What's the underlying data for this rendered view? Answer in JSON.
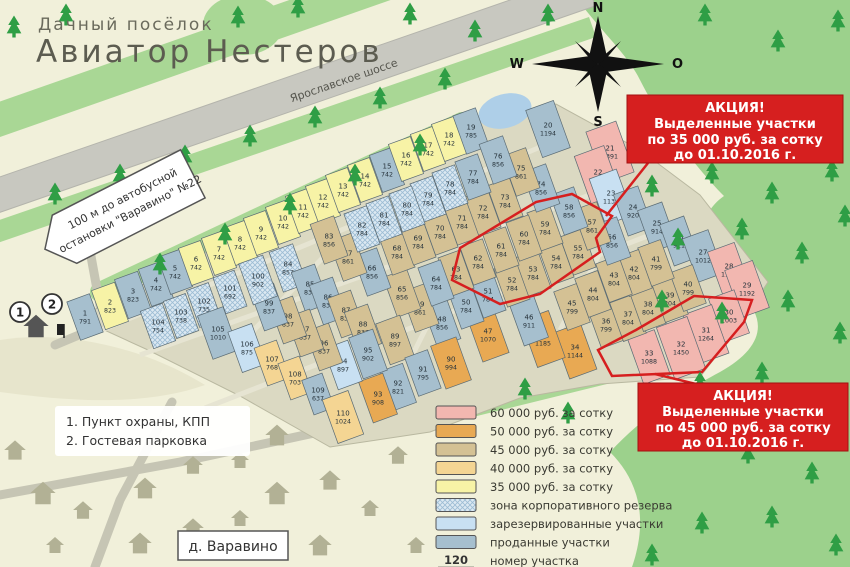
{
  "title": {
    "line1": "Дачный посёлок",
    "line2": "Авиатор Нестеров"
  },
  "highway_label": "Ярославское шоссе",
  "bus_sign": {
    "line1": "100 м до автобусной",
    "line2": "остановки \"Варавино\" №22"
  },
  "village_label": "д. Варавино",
  "compass": {
    "n": "N",
    "w": "W",
    "e": "O",
    "s": "S"
  },
  "notes": {
    "line1": "1. Пункт охраны, КПП",
    "line2": "2. Гостевая парковка"
  },
  "entrance_markers": {
    "m1": "1",
    "m2": "2"
  },
  "promo_boxes": [
    {
      "lines": [
        "АКЦИЯ!",
        "Выделенные участки",
        "по 35 000 руб. за сотку",
        "до 01.10.2016 г."
      ]
    },
    {
      "lines": [
        "АКЦИЯ!",
        "Выделенные участки",
        "по 45 000 руб. за сотку",
        "до 01.10.2016 г."
      ]
    }
  ],
  "promo35_plots": [
    52,
    53,
    54,
    55,
    57,
    59,
    60,
    61,
    62
  ],
  "promo45_plots": [
    30,
    31,
    32,
    33
  ],
  "legend": {
    "items": [
      {
        "code": "p",
        "label": "60 000 руб. за сотку"
      },
      {
        "code": "o",
        "label": "50 000 руб. за сотку"
      },
      {
        "code": "t",
        "label": "45 000 руб. за сотку"
      },
      {
        "code": "f",
        "label": "40 000 руб. за сотку"
      },
      {
        "code": "y",
        "label": "35 000 руб. за сотку"
      },
      {
        "code": "z",
        "label": "зона корпоративного резерва"
      },
      {
        "code": "r",
        "label": "зарезервированные участки"
      },
      {
        "code": "s",
        "label": "проданные участки"
      }
    ],
    "key_number": "120",
    "key_area": "1 200",
    "key_number_label": "номер участка",
    "key_area_label": "площадь участка, м.кв."
  },
  "colors": {
    "p": "#f2b7b0",
    "o": "#e8a953",
    "t": "#d4c194",
    "f": "#f4d593",
    "y": "#f7f3a6",
    "z": "#dce9f2",
    "r": "#c8e0f2",
    "s": "#a6bfce",
    "promo_red": "#d61f1f",
    "forest": "#9cd18c",
    "tree": "#2f9e45",
    "road": "#c8c8c0",
    "water": "#aecfe8"
  },
  "plots": [
    {
      "n": 1,
      "a": 791,
      "c": "s",
      "x": 85,
      "y": 317
    },
    {
      "n": 2,
      "a": 823,
      "c": "y",
      "x": 110,
      "y": 306
    },
    {
      "n": 3,
      "a": 823,
      "c": "s",
      "x": 133,
      "y": 295
    },
    {
      "n": 4,
      "a": 742,
      "c": "s",
      "x": 156,
      "y": 284
    },
    {
      "n": 5,
      "a": 742,
      "c": "s",
      "x": 175,
      "y": 272
    },
    {
      "n": 6,
      "a": 742,
      "c": "y",
      "x": 196,
      "y": 263
    },
    {
      "n": 7,
      "a": 742,
      "c": "y",
      "x": 219,
      "y": 253
    },
    {
      "n": 8,
      "a": 742,
      "c": "y",
      "x": 240,
      "y": 243
    },
    {
      "n": 9,
      "a": 742,
      "c": "y",
      "x": 261,
      "y": 233
    },
    {
      "n": 10,
      "a": 742,
      "c": "y",
      "x": 283,
      "y": 222
    },
    {
      "n": 11,
      "a": 742,
      "c": "y",
      "x": 303,
      "y": 211
    },
    {
      "n": 12,
      "a": 742,
      "c": "y",
      "x": 323,
      "y": 201
    },
    {
      "n": 13,
      "a": 742,
      "c": "y",
      "x": 343,
      "y": 190
    },
    {
      "n": 14,
      "a": 742,
      "c": "y",
      "x": 365,
      "y": 180
    },
    {
      "n": 15,
      "a": 742,
      "c": "s",
      "x": 387,
      "y": 170
    },
    {
      "n": 16,
      "a": 742,
      "c": "y",
      "x": 406,
      "y": 159
    },
    {
      "n": 17,
      "a": 742,
      "c": "y",
      "x": 428,
      "y": 149
    },
    {
      "n": 18,
      "a": 742,
      "c": "y",
      "x": 449,
      "y": 139
    },
    {
      "n": 19,
      "a": 785,
      "c": "s",
      "x": 471,
      "y": 131
    },
    {
      "n": 20,
      "a": 1194,
      "c": "s",
      "x": 548,
      "y": 129
    },
    {
      "n": 21,
      "a": 1391,
      "c": "p",
      "x": 610,
      "y": 152
    },
    {
      "n": 22,
      "a": 1349,
      "c": "p",
      "x": 598,
      "y": 176
    },
    {
      "n": 23,
      "a": 1135,
      "c": "r",
      "x": 611,
      "y": 197
    },
    {
      "n": 24,
      "a": 920,
      "c": "s",
      "x": 633,
      "y": 211
    },
    {
      "n": 25,
      "a": 914,
      "c": "s",
      "x": 657,
      "y": 227
    },
    {
      "n": 26,
      "a": 911,
      "c": "s",
      "x": 679,
      "y": 241
    },
    {
      "n": 27,
      "a": 1012,
      "c": "s",
      "x": 703,
      "y": 256
    },
    {
      "n": 28,
      "a": 1112,
      "c": "p",
      "x": 729,
      "y": 270
    },
    {
      "n": 29,
      "a": 1192,
      "c": "p",
      "x": 747,
      "y": 289
    },
    {
      "n": 30,
      "a": 1003,
      "c": "p",
      "x": 729,
      "y": 316
    },
    {
      "n": 31,
      "a": 1264,
      "c": "p",
      "x": 706,
      "y": 334
    },
    {
      "n": 32,
      "a": 1450,
      "c": "p",
      "x": 681,
      "y": 348
    },
    {
      "n": 33,
      "a": 1088,
      "c": "p",
      "x": 649,
      "y": 357
    },
    {
      "n": 34,
      "a": 1144,
      "c": "o",
      "x": 575,
      "y": 351
    },
    {
      "n": 35,
      "a": 1185,
      "c": "o",
      "x": 543,
      "y": 339
    },
    {
      "n": 36,
      "a": 799,
      "c": "t",
      "x": 606,
      "y": 325
    },
    {
      "n": 37,
      "a": 804,
      "c": "t",
      "x": 628,
      "y": 318
    },
    {
      "n": 38,
      "a": 804,
      "c": "t",
      "x": 648,
      "y": 308
    },
    {
      "n": 39,
      "a": 804,
      "c": "t",
      "x": 670,
      "y": 299
    },
    {
      "n": 40,
      "a": 799,
      "c": "t",
      "x": 688,
      "y": 288
    },
    {
      "n": 41,
      "a": 799,
      "c": "t",
      "x": 656,
      "y": 263
    },
    {
      "n": 42,
      "a": 804,
      "c": "t",
      "x": 634,
      "y": 273
    },
    {
      "n": 43,
      "a": 804,
      "c": "t",
      "x": 614,
      "y": 279
    },
    {
      "n": 44,
      "a": 804,
      "c": "t",
      "x": 593,
      "y": 294
    },
    {
      "n": 45,
      "a": 799,
      "c": "t",
      "x": 572,
      "y": 307
    },
    {
      "n": 46,
      "a": 911,
      "c": "s",
      "x": 529,
      "y": 321
    },
    {
      "n": 47,
      "a": 1070,
      "c": "o",
      "x": 488,
      "y": 335
    },
    {
      "n": 48,
      "a": 856,
      "c": "s",
      "x": 442,
      "y": 323
    },
    {
      "n": 49,
      "a": 861,
      "c": "t",
      "x": 420,
      "y": 308
    },
    {
      "n": 50,
      "a": 784,
      "c": "s",
      "x": 466,
      "y": 306
    },
    {
      "n": 51,
      "a": 784,
      "c": "s",
      "x": 488,
      "y": 295
    },
    {
      "n": 52,
      "a": 784,
      "c": "t",
      "x": 512,
      "y": 284
    },
    {
      "n": 53,
      "a": 784,
      "c": "t",
      "x": 533,
      "y": 273
    },
    {
      "n": 54,
      "a": 784,
      "c": "t",
      "x": 556,
      "y": 262
    },
    {
      "n": 55,
      "a": 784,
      "c": "t",
      "x": 578,
      "y": 252
    },
    {
      "n": 56,
      "a": 856,
      "c": "s",
      "x": 612,
      "y": 241
    },
    {
      "n": 57,
      "a": 861,
      "c": "t",
      "x": 592,
      "y": 226
    },
    {
      "n": 58,
      "a": 856,
      "c": "s",
      "x": 569,
      "y": 211
    },
    {
      "n": 59,
      "a": 784,
      "c": "t",
      "x": 545,
      "y": 228
    },
    {
      "n": 60,
      "a": 784,
      "c": "t",
      "x": 524,
      "y": 238
    },
    {
      "n": 61,
      "a": 784,
      "c": "t",
      "x": 501,
      "y": 250
    },
    {
      "n": 62,
      "a": 784,
      "c": "t",
      "x": 478,
      "y": 262
    },
    {
      "n": 63,
      "a": 784,
      "c": "t",
      "x": 456,
      "y": 273
    },
    {
      "n": 64,
      "a": 784,
      "c": "s",
      "x": 436,
      "y": 283
    },
    {
      "n": 65,
      "a": 856,
      "c": "t",
      "x": 402,
      "y": 293
    },
    {
      "n": 66,
      "a": 856,
      "c": "s",
      "x": 372,
      "y": 272
    },
    {
      "n": 67,
      "a": 861,
      "c": "t",
      "x": 348,
      "y": 257
    },
    {
      "n": 68,
      "a": 784,
      "c": "t",
      "x": 397,
      "y": 252
    },
    {
      "n": 69,
      "a": 784,
      "c": "t",
      "x": 418,
      "y": 242
    },
    {
      "n": 70,
      "a": 784,
      "c": "t",
      "x": 440,
      "y": 232
    },
    {
      "n": 71,
      "a": 784,
      "c": "t",
      "x": 462,
      "y": 222
    },
    {
      "n": 72,
      "a": 784,
      "c": "t",
      "x": 483,
      "y": 212
    },
    {
      "n": 73,
      "a": 784,
      "c": "t",
      "x": 505,
      "y": 201
    },
    {
      "n": 74,
      "a": 856,
      "c": "s",
      "x": 541,
      "y": 188
    },
    {
      "n": 75,
      "a": 861,
      "c": "t",
      "x": 521,
      "y": 172
    },
    {
      "n": 76,
      "a": 856,
      "c": "s",
      "x": 498,
      "y": 160
    },
    {
      "n": 77,
      "a": 784,
      "c": "s",
      "x": 473,
      "y": 177
    },
    {
      "n": 78,
      "a": 784,
      "c": "z",
      "x": 450,
      "y": 188
    },
    {
      "n": 79,
      "a": 784,
      "c": "z",
      "x": 428,
      "y": 199
    },
    {
      "n": 80,
      "a": 784,
      "c": "z",
      "x": 407,
      "y": 209
    },
    {
      "n": 81,
      "a": 784,
      "c": "z",
      "x": 384,
      "y": 219
    },
    {
      "n": 82,
      "a": 784,
      "c": "z",
      "x": 362,
      "y": 229
    },
    {
      "n": 83,
      "a": 856,
      "c": "t",
      "x": 329,
      "y": 240
    },
    {
      "n": 84,
      "a": 857,
      "c": "z",
      "x": 288,
      "y": 268
    },
    {
      "n": 85,
      "a": 837,
      "c": "s",
      "x": 310,
      "y": 288
    },
    {
      "n": 86,
      "a": 837,
      "c": "s",
      "x": 328,
      "y": 301
    },
    {
      "n": 87,
      "a": 837,
      "c": "t",
      "x": 346,
      "y": 314
    },
    {
      "n": 88,
      "a": 837,
      "c": "t",
      "x": 363,
      "y": 328
    },
    {
      "n": 89,
      "a": 897,
      "c": "t",
      "x": 395,
      "y": 340
    },
    {
      "n": 90,
      "a": 994,
      "c": "o",
      "x": 451,
      "y": 363
    },
    {
      "n": 91,
      "a": 795,
      "c": "s",
      "x": 423,
      "y": 373
    },
    {
      "n": 92,
      "a": 821,
      "c": "s",
      "x": 398,
      "y": 387
    },
    {
      "n": 93,
      "a": 908,
      "c": "o",
      "x": 378,
      "y": 398
    },
    {
      "n": 94,
      "a": 897,
      "c": "r",
      "x": 343,
      "y": 365
    },
    {
      "n": 95,
      "a": 902,
      "c": "s",
      "x": 368,
      "y": 354
    },
    {
      "n": 96,
      "a": 837,
      "c": "t",
      "x": 324,
      "y": 347
    },
    {
      "n": 97,
      "a": 837,
      "c": "t",
      "x": 305,
      "y": 333
    },
    {
      "n": 98,
      "a": 837,
      "c": "t",
      "x": 288,
      "y": 320
    },
    {
      "n": 99,
      "a": 837,
      "c": "s",
      "x": 269,
      "y": 307
    },
    {
      "n": 100,
      "a": 902,
      "c": "z",
      "x": 258,
      "y": 280
    },
    {
      "n": 101,
      "a": 692,
      "c": "z",
      "x": 230,
      "y": 292
    },
    {
      "n": 102,
      "a": 735,
      "c": "z",
      "x": 204,
      "y": 305
    },
    {
      "n": 103,
      "a": 738,
      "c": "z",
      "x": 181,
      "y": 316
    },
    {
      "n": 104,
      "a": 754,
      "c": "z",
      "x": 158,
      "y": 326
    },
    {
      "n": 105,
      "a": 1010,
      "c": "s",
      "x": 218,
      "y": 333
    },
    {
      "n": 106,
      "a": 875,
      "c": "r",
      "x": 247,
      "y": 348
    },
    {
      "n": 107,
      "a": 768,
      "c": "f",
      "x": 272,
      "y": 363
    },
    {
      "n": 108,
      "a": 703,
      "c": "f",
      "x": 295,
      "y": 378
    },
    {
      "n": 109,
      "a": 637,
      "c": "s",
      "x": 318,
      "y": 394
    },
    {
      "n": 110,
      "a": 1024,
      "c": "f",
      "x": 343,
      "y": 417
    }
  ]
}
